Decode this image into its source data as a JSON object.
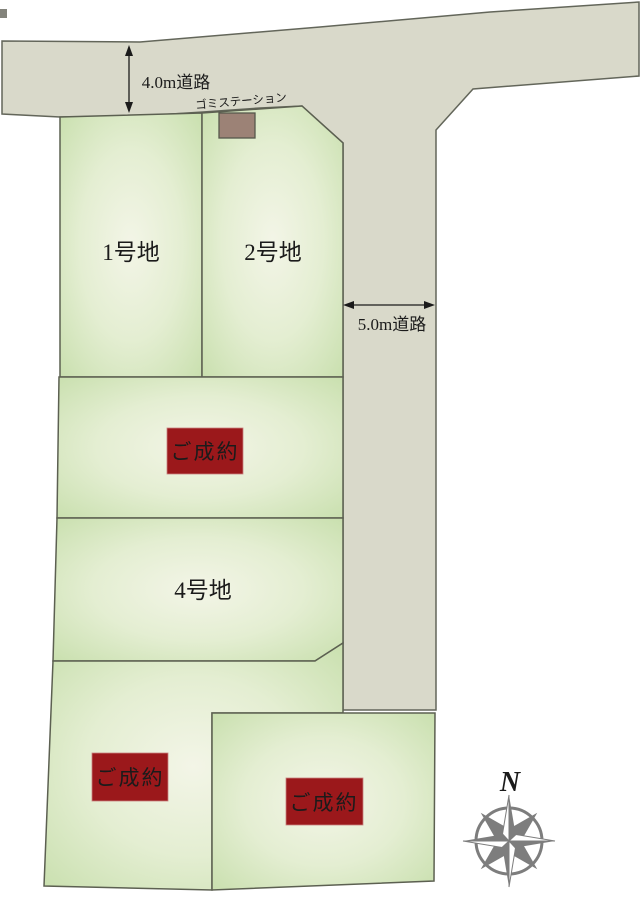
{
  "site": {
    "roads": {
      "top": {
        "label": "4.0m道路"
      },
      "side": {
        "label": "5.0m道路"
      }
    },
    "garbage_station": {
      "label": "ゴミステーション"
    },
    "lots": [
      {
        "name": "lot-1",
        "label": "1号地",
        "status": "available"
      },
      {
        "name": "lot-2",
        "label": "2号地",
        "status": "available"
      },
      {
        "name": "lot-3",
        "label": "ご成約",
        "status": "sold"
      },
      {
        "name": "lot-4",
        "label": "4号地",
        "status": "available"
      },
      {
        "name": "lot-5",
        "label": "ご成約",
        "status": "sold"
      },
      {
        "name": "lot-6",
        "label": "ご成約",
        "status": "sold"
      }
    ],
    "compass": {
      "north_label": "N"
    },
    "colors": {
      "road": "#d9d9ca",
      "plot_center": "#f3f5e7",
      "plot_mid": "#e4eed2",
      "plot_edge": "#c8dfad",
      "outline": "#5c6051",
      "badge_bg": "#9b181b",
      "badge_text": "#ffffff",
      "garbage_box": "#9c8276",
      "compass": "#7d7d7d",
      "dimension": "#1b1b1b"
    }
  }
}
